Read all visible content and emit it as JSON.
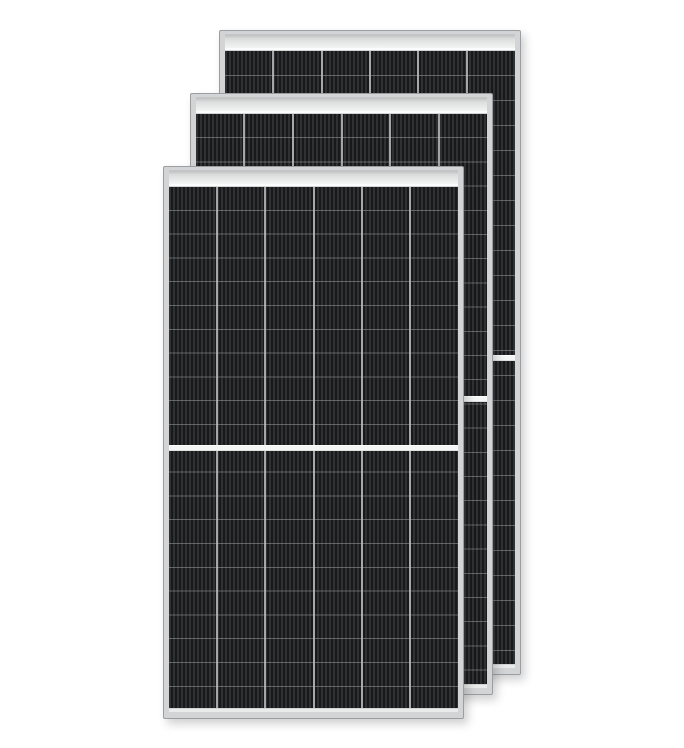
{
  "scene": {
    "type": "product-photo",
    "description": "Three identical black monocrystalline half-cut solar panels with silver aluminum frames, fanned from front-left to back-right on a white background",
    "background_color": "#ffffff",
    "panel_count": 3,
    "panels": [
      {
        "id": "back",
        "position": "rear, shifted up-right",
        "cell_columns": 6,
        "cell_rows_per_half": 12,
        "center_divider": true,
        "top_rail": true
      },
      {
        "id": "middle",
        "position": "middle of stack",
        "cell_columns": 6,
        "cell_rows_per_half": 12,
        "center_divider": true,
        "top_rail": true
      },
      {
        "id": "front",
        "position": "front, shifted down-left",
        "cell_columns": 6,
        "cell_rows_per_half": 11,
        "center_divider": true,
        "top_rail": true
      }
    ],
    "colors": {
      "frame": "#d2d4d5",
      "frame_edge": "#9b9ea0",
      "rail_dark": "#bfc1c2",
      "rail_light": "#f3f4f4",
      "bottom_strip": "#e9eaea",
      "cell_base": "#222426",
      "cell_stripe_light": "#2f3133",
      "cell_stripe_dark": "#17191b",
      "column_line": "#babec0",
      "row_line": "rgba(190,194,196,0.42)",
      "center_divider": "#f4f5f5"
    }
  }
}
